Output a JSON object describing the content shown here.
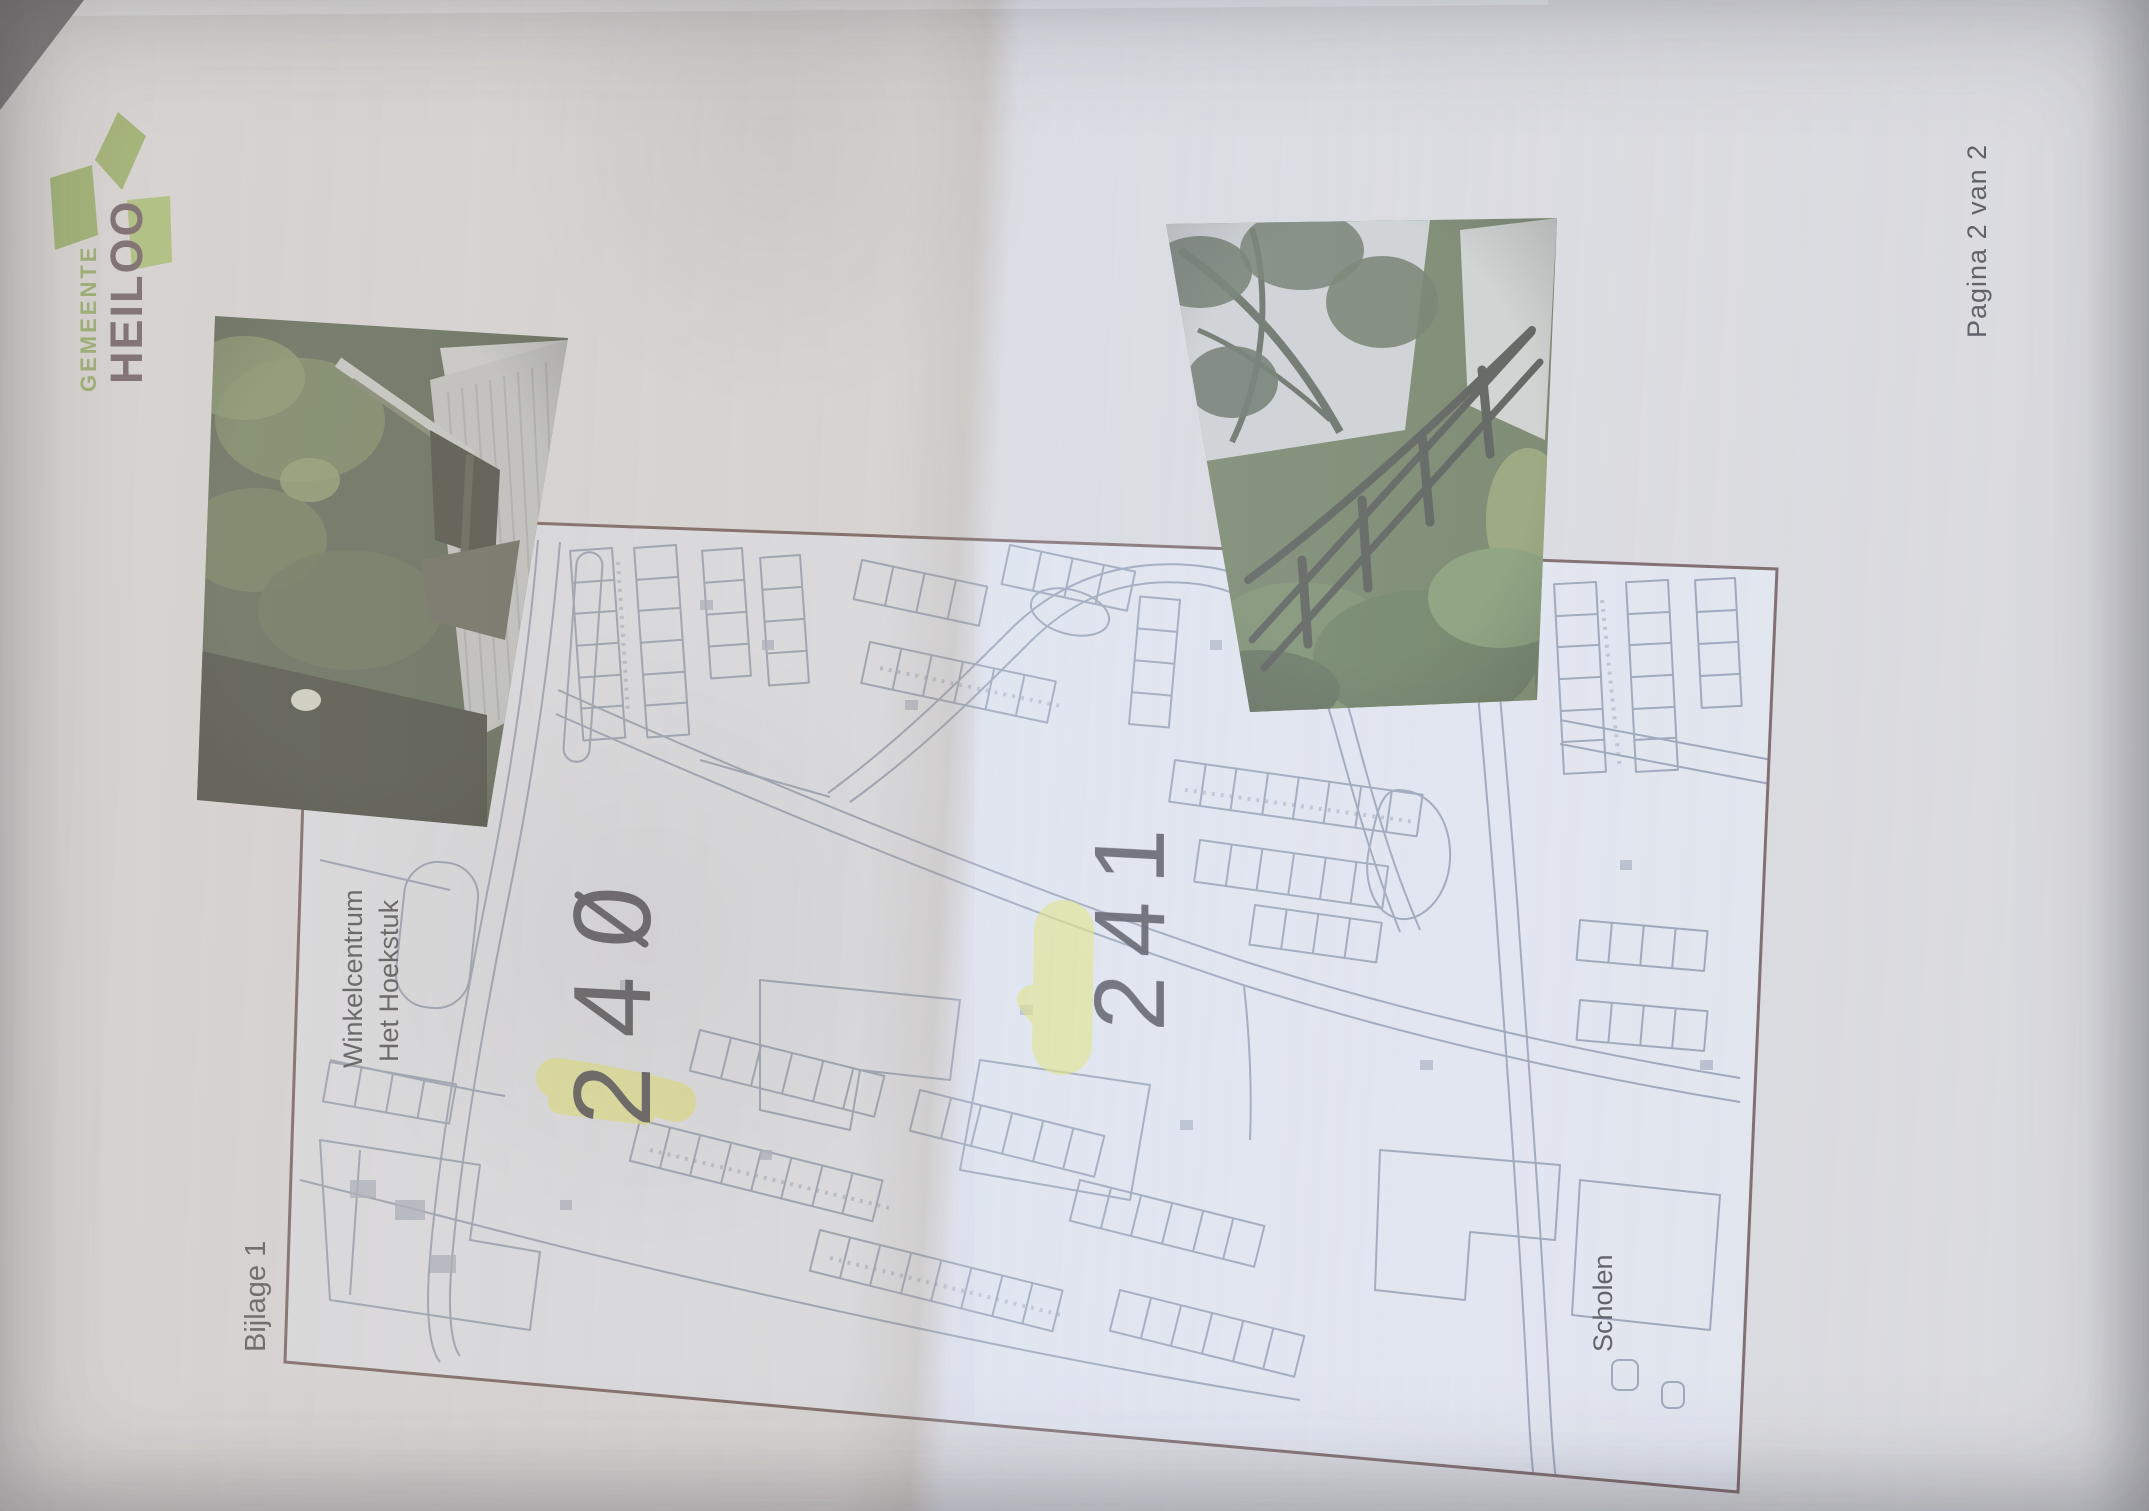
{
  "document": {
    "page_label": "Pagina 2 van 2",
    "attachment_label": "Bijlage 1"
  },
  "logo": {
    "top_text": "GEMEENTE",
    "bottom_text": "HEILOO"
  },
  "map": {
    "labels": {
      "shopping_center_line1": "Winkelcentrum",
      "shopping_center_line2": "Het Hoekstuk",
      "schools": "Scholen"
    },
    "annotations": [
      {
        "text": "240",
        "highlighted": true,
        "slashed_zero": true
      },
      {
        "text": "241",
        "highlighted": true
      }
    ],
    "colors": {
      "border": "#5e4242",
      "background": "#dde0e9",
      "lines": "#8692a8",
      "highlight": "#e3e554",
      "ink": "#26262e"
    }
  },
  "colors": {
    "paper": "#d9d8db",
    "logo_green": "#86a64b",
    "logo_green_light": "#9cba5e",
    "logo_text_green": "#7f9e45",
    "logo_text_dark": "#4e3a44",
    "label_ink": "#34343a"
  }
}
